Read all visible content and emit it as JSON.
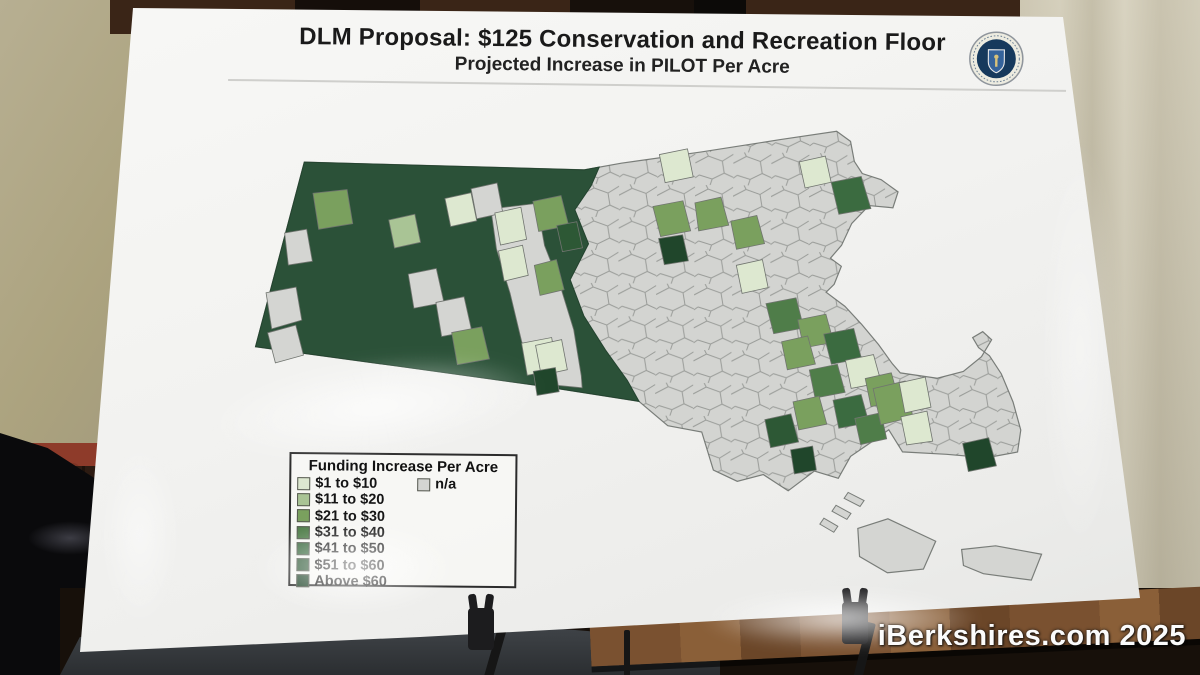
{
  "photo": {
    "watermark": "iBerkshires.com 2025"
  },
  "poster": {
    "title": "DLM Proposal: $125 Conservation and Recreation Floor",
    "subtitle": "Projected Increase in PILOT Per Acre",
    "seal_name": "Massachusetts state seal"
  },
  "legend": {
    "title": "Funding Increase Per Acre",
    "items": [
      {
        "label": "$1 to $10",
        "color": "#dde8d0"
      },
      {
        "label": "$11 to $20",
        "color": "#a9c495"
      },
      {
        "label": "$21 to $30",
        "color": "#7aa05e"
      },
      {
        "label": "$31 to $40",
        "color": "#4f7d49"
      },
      {
        "label": "$41 to $50",
        "color": "#3b6b40"
      },
      {
        "label": "$51 to $60",
        "color": "#2d5835"
      },
      {
        "label": "Above $60",
        "color": "#20462b"
      }
    ],
    "na_item": {
      "label": "n/a",
      "color": "#d4d5d2"
    }
  },
  "chart_data": {
    "type": "choropleth",
    "geography": "Massachusetts municipalities (cities and towns)",
    "title": "DLM Proposal: $125 Conservation and Recreation Floor",
    "subtitle": "Projected Increase in PILOT Per Acre",
    "legend_title": "Funding Increase Per Acre",
    "legend_position": "bottom-left box",
    "classes": [
      {
        "label": "$1 to $10",
        "color": "#dde8d0"
      },
      {
        "label": "$11 to $20",
        "color": "#a9c495"
      },
      {
        "label": "$21 to $30",
        "color": "#7aa05e"
      },
      {
        "label": "$31 to $40",
        "color": "#4f7d49"
      },
      {
        "label": "$41 to $50",
        "color": "#3b6b40"
      },
      {
        "label": "$51 to $60",
        "color": "#2d5835"
      },
      {
        "label": "Above $60",
        "color": "#20462b"
      },
      {
        "label": "n/a",
        "color": "#d4d5d2"
      }
    ],
    "pattern_summary": "Western Massachusetts (Berkshires and hill towns) is shaded in the darkest greens (largest projected PILOT increase per acre); the Connecticut River valley holds a strip of gray and pale-green towns; central and greater-Boston municipalities are mostly gray n/a with scattered light-to-dark green towns; a cluster of mid-green towns appears in southeastern Massachusetts (Plymouth County); Cape Cod, Martha's Vineyard and Nantucket are mostly gray n/a with one dark-green town on the mid-Cape."
  }
}
